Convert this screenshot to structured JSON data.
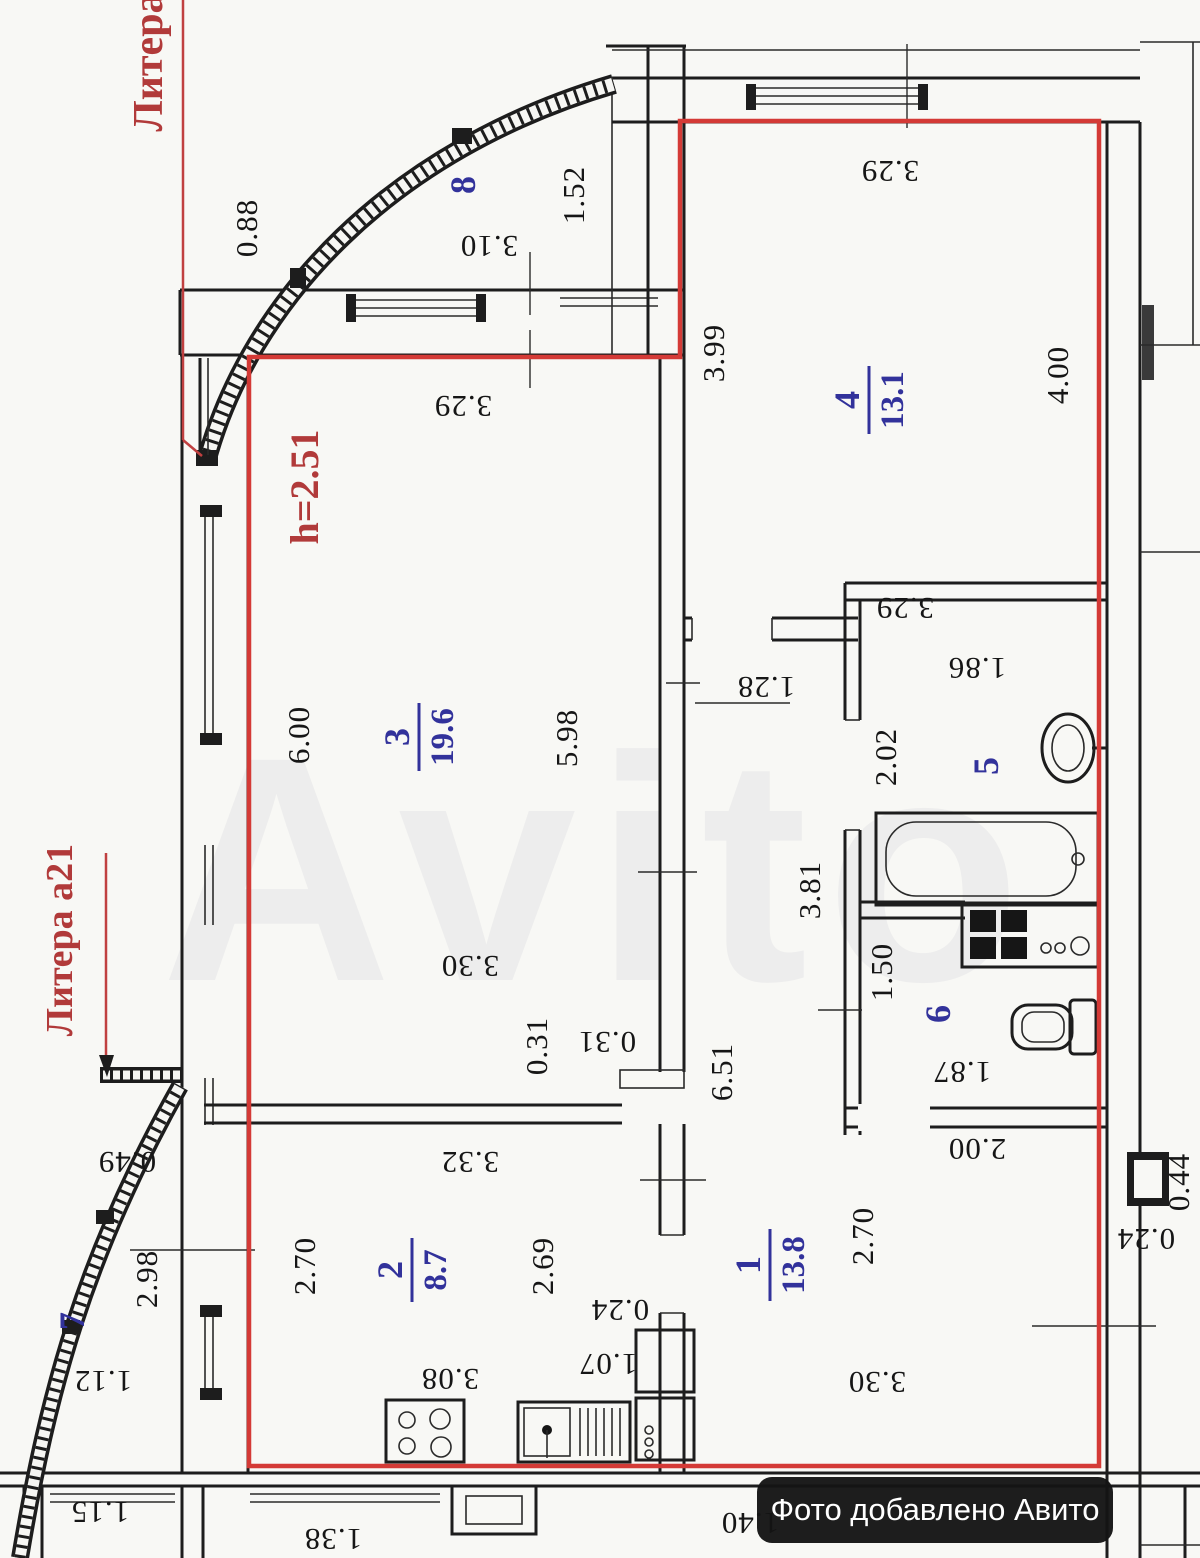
{
  "labels": {
    "litera_top": "Литера",
    "litera_left": "Литера а21",
    "ceiling_height": "h=2.51",
    "badge": "Фото добавлено Авито",
    "watermark": "Avito"
  },
  "rooms": {
    "r1": {
      "num": "1",
      "area": "13.8"
    },
    "r2": {
      "num": "2",
      "area": "8.7"
    },
    "r3": {
      "num": "3",
      "area": "19.6"
    },
    "r4": {
      "num": "4",
      "area": "13.1"
    },
    "r5": {
      "num": "5"
    },
    "r6": {
      "num": "6"
    },
    "r7": {
      "num": "7"
    },
    "r8": {
      "num": "8"
    }
  },
  "dims": {
    "d088": "0.88",
    "d310": "3.10",
    "d152": "1.52",
    "d329a": "3.29",
    "d399": "3.99",
    "d400": "4.00",
    "d329b": "3.29",
    "d600": "6.00",
    "d598": "5.98",
    "d329c": "3.29",
    "d128": "1.28",
    "d186": "1.86",
    "d202": "2.02",
    "d381": "3.81",
    "d150": "1.50",
    "d187": "1.87",
    "d200": "2.00",
    "d651": "6.51",
    "d330a": "3.30",
    "d031a": "0.31",
    "d031b": "0.31",
    "d332": "3.32",
    "d049": "0.49",
    "d298": "2.98",
    "d270a": "2.70",
    "d269": "2.69",
    "d112": "1.12",
    "d115": "1.15",
    "d308": "3.08",
    "d024a": "0.24",
    "d107": "1.07",
    "d270b": "2.70",
    "d330b": "3.30",
    "d044": "0.44",
    "d024b": "0.24",
    "d138": "1.38",
    "d140": "1.40"
  }
}
